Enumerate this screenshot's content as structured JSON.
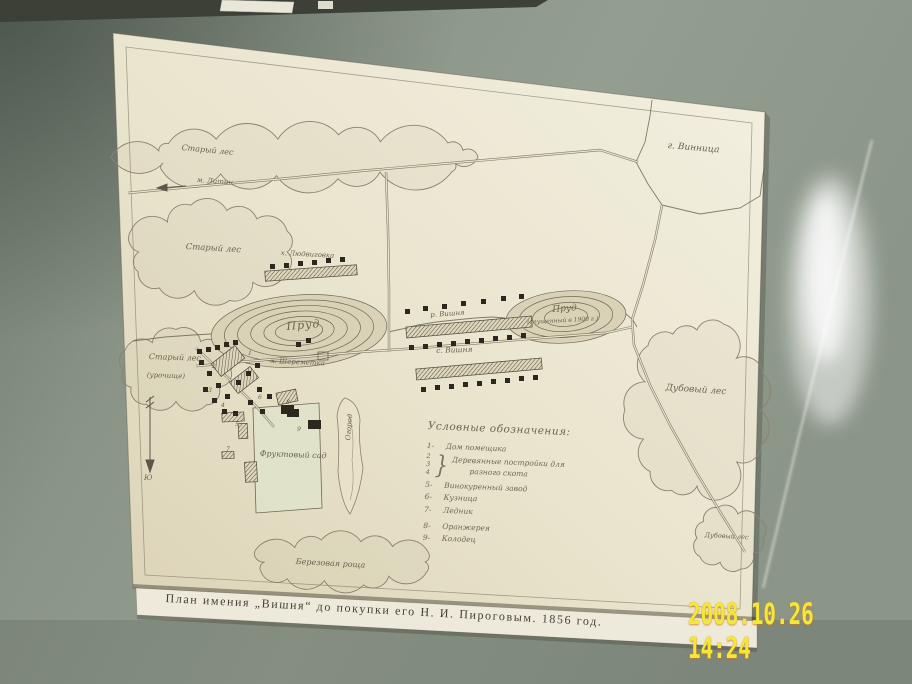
{
  "photo": {
    "timestamp": "2008.10.26 14:24"
  },
  "caption": "План имения „Вишня“ до покупки его Н. И. Пироговым. 1856 год.",
  "colors": {
    "wall": "#8f998b",
    "paper": "#e9e4cd",
    "ink": "#6b6250",
    "timestamp": "#f2e838"
  },
  "map": {
    "labels": {
      "vinnitsa": "г. Винница",
      "old_forest_top": "Старый лес",
      "litin": "м. Литин",
      "old_forest_left": "Старый лес",
      "old_forest_sw_1": "Старый лес",
      "old_forest_sw_2": "(урочище)",
      "lyudvigovka": "х. Людвиговка",
      "pond_left": "Пруд",
      "river": "р. Вишня",
      "village": "с. Вишня",
      "pond_right_1": "Пруд",
      "pond_right_2": "(спущенный в 1900 г.)",
      "oak_forest": "Дубовый лес",
      "oak_forest_small": "Дубовый лес",
      "birch_grove": "Березовая роща",
      "orchard": "Фруктовый сад",
      "kitchen_garden": "Огород",
      "sheremetka": "х. Шереметка",
      "south": "Ю"
    },
    "markers": [
      {
        "n": "1"
      },
      {
        "n": "2"
      },
      {
        "n": "3"
      },
      {
        "n": "4"
      },
      {
        "n": "5"
      },
      {
        "n": "6"
      },
      {
        "n": "7"
      },
      {
        "n": "8"
      },
      {
        "n": "9"
      }
    ],
    "legend": {
      "title": "Условные обозначения:",
      "item_1": {
        "key": "1-",
        "label": "Дом помещика"
      },
      "group": {
        "keys": [
          "2",
          "3",
          "4"
        ],
        "brace": "}",
        "line1": "Деревянные постройки для",
        "line2": "разного скота"
      },
      "item_5": {
        "key": "5-",
        "label": "Винокуренный завод"
      },
      "item_6": {
        "key": "6-",
        "label": "Кузница"
      },
      "item_7": {
        "key": "7-",
        "label": "Ледник"
      },
      "item_8": {
        "key": "8-",
        "label": "Оранжерея"
      },
      "item_9": {
        "key": "9-",
        "label": "Колодец"
      }
    }
  }
}
